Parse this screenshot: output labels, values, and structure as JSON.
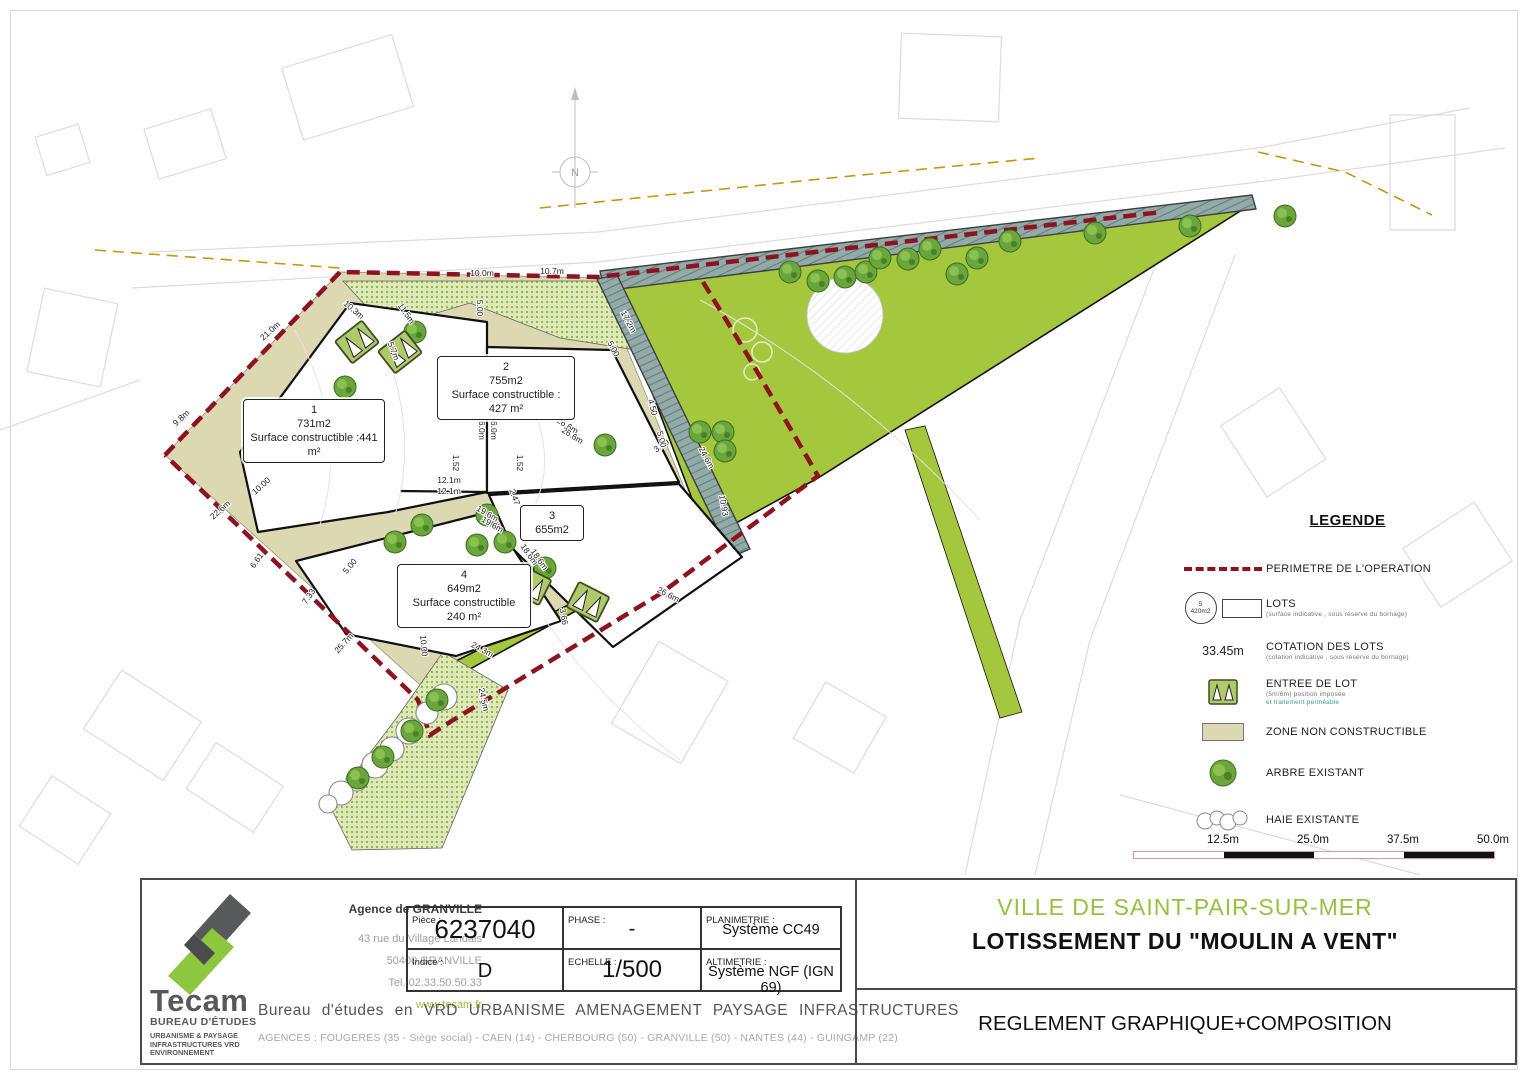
{
  "colors": {
    "accent_green": "#96c13e",
    "perimeter_red": "#8e1220",
    "grass_green": "#a5c73e",
    "beige": "#dbd8b2",
    "strip_bluegray": "#93aba8",
    "ochre": "#c8960c"
  },
  "plan": {
    "north_label": "N",
    "lots": [
      {
        "number": "1",
        "area": "731m2",
        "surface": "Surface constructible :441 m²"
      },
      {
        "number": "2",
        "area": "755m2",
        "surface": "Surface constructible : 427 m²"
      },
      {
        "number": "3",
        "area": "655m2",
        "surface": ""
      },
      {
        "number": "4",
        "area": "649m2",
        "surface": "Surface constructible 240 m²"
      }
    ],
    "dimensions": [
      {
        "t": "21.0m",
        "x": 272,
        "y": 333,
        "r": -42
      },
      {
        "t": "9.8m",
        "x": 183,
        "y": 420,
        "r": -42
      },
      {
        "t": "10.3m",
        "x": 352,
        "y": 312,
        "r": 40
      },
      {
        "t": "11.5m",
        "x": 404,
        "y": 315,
        "r": 55
      },
      {
        "t": "5.7m",
        "x": 391,
        "y": 352,
        "r": 68
      },
      {
        "t": "10.0m",
        "x": 482,
        "y": 276,
        "r": 0
      },
      {
        "t": "10.7m",
        "x": 552,
        "y": 274,
        "r": 0
      },
      {
        "t": "5.00",
        "x": 477,
        "y": 308,
        "r": 90
      },
      {
        "t": "17.2m",
        "x": 626,
        "y": 323,
        "r": 62
      },
      {
        "t": "5.00",
        "x": 611,
        "y": 350,
        "r": 62
      },
      {
        "t": "16.0m",
        "x": 479,
        "y": 428,
        "r": 90
      },
      {
        "t": "16.0m",
        "x": 491,
        "y": 428,
        "r": 90
      },
      {
        "t": "1.52",
        "x": 453,
        "y": 463,
        "r": 90
      },
      {
        "t": "1.52",
        "x": 517,
        "y": 463,
        "r": 90
      },
      {
        "t": "12.1m",
        "x": 449,
        "y": 483,
        "r": 0
      },
      {
        "t": "12.1m",
        "x": 449,
        "y": 494,
        "r": 0
      },
      {
        "t": "26.6m",
        "x": 566,
        "y": 428,
        "r": 32
      },
      {
        "t": "26.6m",
        "x": 571,
        "y": 438,
        "r": 32
      },
      {
        "t": "19.6m",
        "x": 486,
        "y": 516,
        "r": 30
      },
      {
        "t": "19.6m",
        "x": 491,
        "y": 527,
        "r": 30
      },
      {
        "t": "10.00",
        "x": 263,
        "y": 488,
        "r": -42
      },
      {
        "t": "22.6m",
        "x": 222,
        "y": 512,
        "r": -42
      },
      {
        "t": "6.61",
        "x": 259,
        "y": 562,
        "r": -55
      },
      {
        "t": "7.33",
        "x": 311,
        "y": 598,
        "r": -55
      },
      {
        "t": "25.7m",
        "x": 346,
        "y": 645,
        "r": -48
      },
      {
        "t": "10.00",
        "x": 421,
        "y": 646,
        "r": 85
      },
      {
        "t": "24.3m",
        "x": 481,
        "y": 652,
        "r": 28
      },
      {
        "t": "18.6m",
        "x": 527,
        "y": 556,
        "r": 55
      },
      {
        "t": "18.6m",
        "x": 537,
        "y": 561,
        "r": 55
      },
      {
        "t": "2.47",
        "x": 512,
        "y": 498,
        "r": 70
      },
      {
        "t": "3.00",
        "x": 663,
        "y": 448,
        "r": -35
      },
      {
        "t": "4.50",
        "x": 650,
        "y": 408,
        "r": 75
      },
      {
        "t": "5.00",
        "x": 659,
        "y": 440,
        "r": 75
      },
      {
        "t": "24.6m",
        "x": 704,
        "y": 459,
        "r": 62
      },
      {
        "t": "10.93",
        "x": 721,
        "y": 506,
        "r": 80
      },
      {
        "t": "26.6m",
        "x": 667,
        "y": 597,
        "r": 27
      },
      {
        "t": "24.5m",
        "x": 481,
        "y": 700,
        "r": 78
      },
      {
        "t": "3.66",
        "x": 561,
        "y": 617,
        "r": 80
      },
      {
        "t": "5.00",
        "x": 352,
        "y": 568,
        "r": -50
      }
    ],
    "trees": [
      [
        790,
        272
      ],
      [
        818,
        281
      ],
      [
        845,
        277
      ],
      [
        866,
        272
      ],
      [
        880,
        258
      ],
      [
        908,
        259
      ],
      [
        930,
        249
      ],
      [
        957,
        274
      ],
      [
        977,
        258
      ],
      [
        1010,
        241
      ],
      [
        1095,
        233
      ],
      [
        1190,
        226
      ],
      [
        1285,
        216
      ],
      [
        415,
        332
      ],
      [
        345,
        387
      ],
      [
        723,
        432
      ],
      [
        700,
        432
      ],
      [
        725,
        451
      ],
      [
        605,
        445
      ],
      [
        422,
        525
      ],
      [
        395,
        542
      ],
      [
        477,
        545
      ],
      [
        505,
        542
      ],
      [
        545,
        568
      ],
      [
        487,
        515
      ],
      [
        437,
        700
      ],
      [
        412,
        731
      ],
      [
        383,
        757
      ],
      [
        358,
        778
      ]
    ],
    "hedges": [
      [
        444,
        697,
        13
      ],
      [
        427,
        713,
        11
      ],
      [
        409,
        731,
        13
      ],
      [
        392,
        749,
        12
      ],
      [
        375,
        765,
        13
      ],
      [
        357,
        780,
        11
      ],
      [
        341,
        793,
        12
      ],
      [
        328,
        804,
        9
      ]
    ]
  },
  "legend": {
    "title": "LEGENDE",
    "perimetre_label": "PERIMETRE DE L'OPERATION",
    "lots_icon_number": "5",
    "lots_icon_area": "420m2",
    "lots_label": "LOTS",
    "lots_sub": "(surface indicative , sous réserve du bornage)",
    "cotation_value": "33.45m",
    "cotation_label": "COTATION DES LOTS",
    "cotation_sub": "(cotation indicative , sous réserve du bornage)",
    "entree_label": "ENTREE DE LOT",
    "entree_sub1": "(5m/6m) position imposée",
    "entree_sub2": "et traitement perméable",
    "zone_label": "ZONE NON CONSTRUCTIBLE",
    "arbre_label": "ARBRE EXISTANT",
    "haie_label": "HAIE EXISTANTE"
  },
  "scalebar": {
    "labels": [
      "12.5m",
      "25.0m",
      "37.5m",
      "50.0m"
    ]
  },
  "titleblock": {
    "company_name": "Tecam",
    "company_sub": "BUREAU D'ÉTUDES",
    "company_tag1": "URBANISME & PAYSAGE",
    "company_tag2": "INFRASTRUCTURES VRD",
    "company_tag3": "ENVIRONNEMENT",
    "agency_title": "Agence de GRANVILLE",
    "agency_line1": "43 rue du Village Landais",
    "agency_line2": "50400 GRANVILLE",
    "agency_line3": "Tel. 02.33.50.50.33",
    "website": "www.tecam.fr",
    "piece_label": "Pièce :",
    "piece_value": "6237040",
    "phase_label": "PHASE :",
    "phase_value": "-",
    "plani_label": "PLANIMETRIE :",
    "plani_value": "Système CC49",
    "indice_label": "Indice :",
    "indice_value": "D",
    "echelle_label": "ECHELLE :",
    "echelle_value": "1/500",
    "alti_label": "ALTIMETRIE :",
    "alti_value": "Système NGF (IGN 69)",
    "bureau_line": "Bureau d'études en VRD  URBANISME  AMENAGEMENT  PAYSAGE  INFRASTRUCTURES",
    "agences_line": "AGENCES :  FOUGERES (35 - Siège social) - CAEN (14) - CHERBOURG (50) - GRANVILLE (50) - NANTES (44) - GUINGAMP (22)",
    "city": "VILLE DE SAINT-PAIR-SUR-MER",
    "project": "LOTISSEMENT DU \"MOULIN A VENT\"",
    "doc_title": "REGLEMENT GRAPHIQUE+COMPOSITION"
  }
}
